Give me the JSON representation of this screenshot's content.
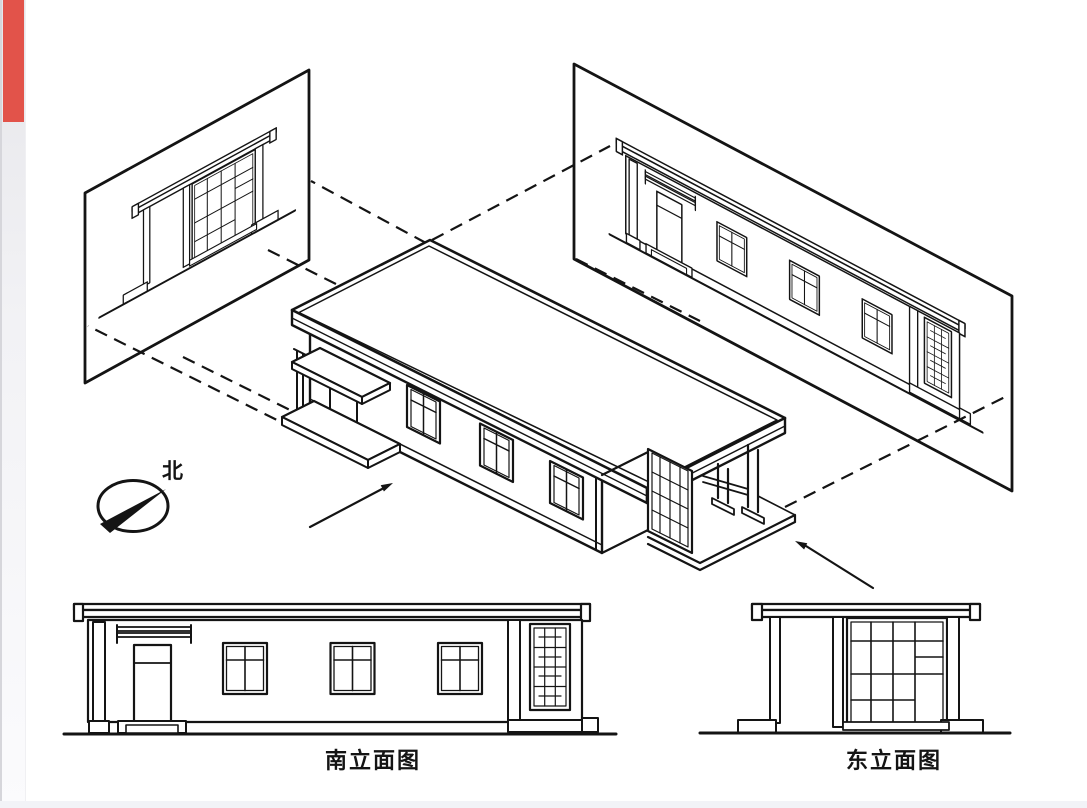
{
  "page": {
    "background": "#ffffff",
    "accent_bar_color": "#e2534a",
    "left_strip_color": "#e6e6ea",
    "bottom_strip_color": "#f2f3f7",
    "line_color": "#141414"
  },
  "compass": {
    "label": "北"
  },
  "captions": {
    "south_elevation": "南立面图",
    "east_elevation": "东立面图"
  }
}
